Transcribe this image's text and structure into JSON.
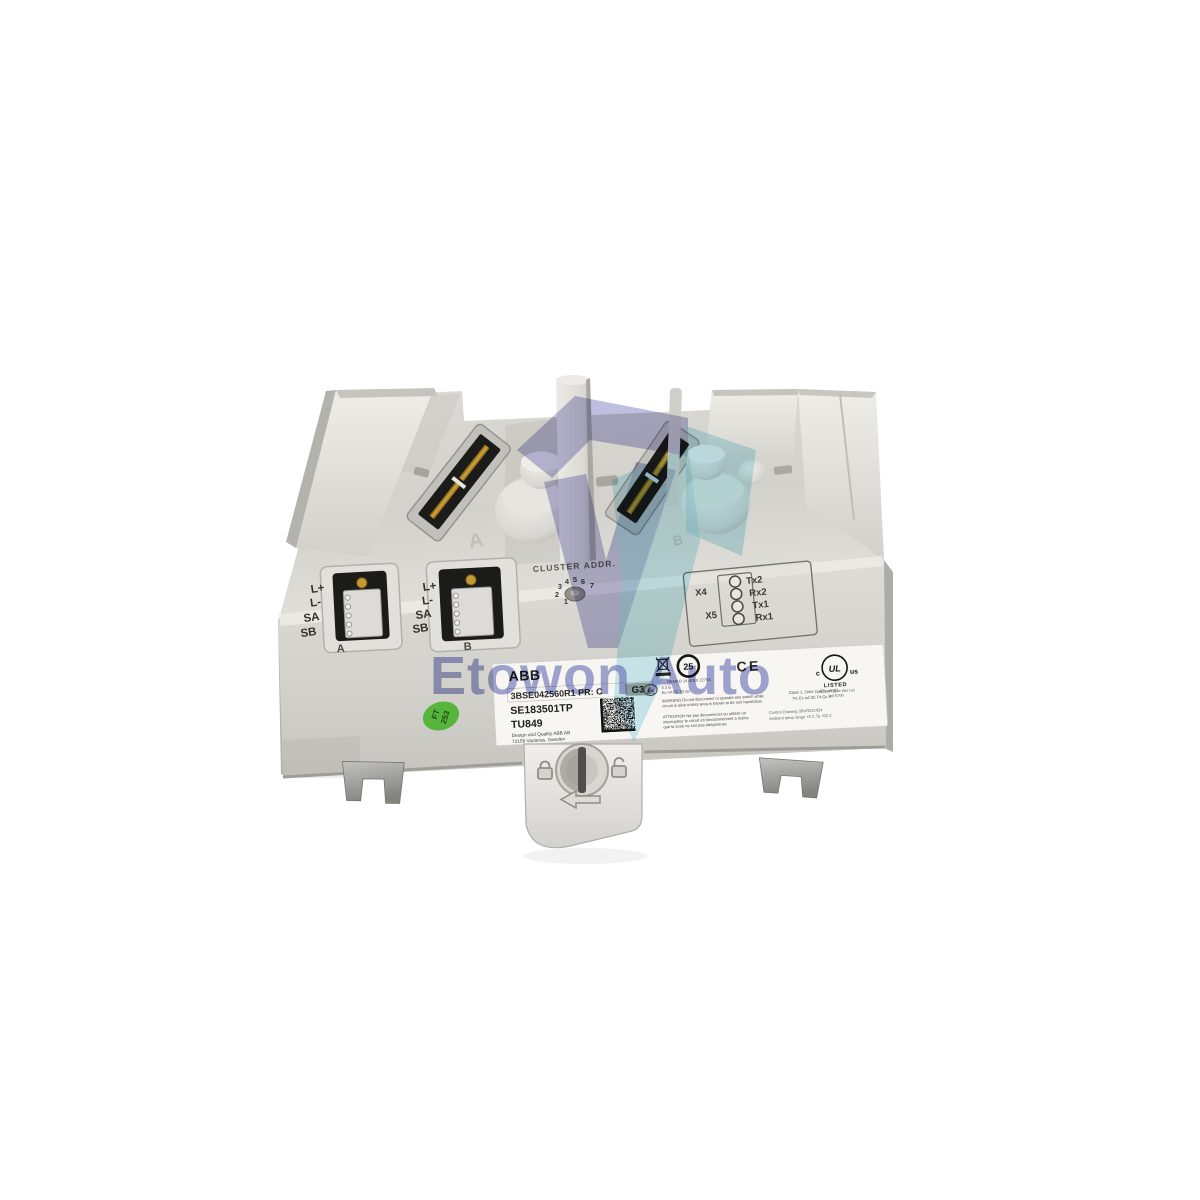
{
  "watermark": {
    "text": "Etowon Auto",
    "purple": "#7d80c0",
    "teal": "#8fd4e4",
    "text_color": "#5f68b8"
  },
  "deck": {
    "embossed_a": "A",
    "embossed_b": "B"
  },
  "cluster": {
    "label": "CLUSTER ADDR.",
    "digits": [
      "1",
      "2",
      "3",
      "4",
      "5",
      "6",
      "7"
    ]
  },
  "led_panel": {
    "x4": "X4",
    "x5": "X5",
    "leds": [
      "Tx2",
      "Rx2",
      "Tx1",
      "Rx1"
    ]
  },
  "terminals": {
    "pins": [
      "L+",
      "L-",
      "SA",
      "SB"
    ],
    "a": "A",
    "b": "B"
  },
  "label": {
    "brand": "ABB",
    "part_row": "3BSE042560R1  PR: C",
    "g3": "G3",
    "serial": "SE183501TP",
    "model": "TU849",
    "maker_line1": "Design and Quality ABB AB",
    "maker_line2": "72159 Vasteras, Sweden",
    "rohs": "25",
    "ex": "Ex",
    "ce": "CE",
    "atex": [
      "DEMKO 14 ATEX 2275X",
      "II 3 G",
      "Ex nA IIC T4 Gc"
    ],
    "warning": [
      "WARNING  Do not disconnect or operate any switch while",
      "circuit is alive unless area is known to be non hazardous"
    ],
    "attention": [
      "ATTENTION  Ne pas deconnecter ou utiliser un",
      "interrupteur le circuit en fonctionnement a moins",
      "que la zone ne soit pas dangereuse"
    ],
    "hazloc": [
      "Class 1, Zone 2, AEx nA IIC",
      "T4,  Ex nA IIC T4 Gc X"
    ],
    "control": [
      "Control Drawing 3BUR021954",
      "Ambient temp range +5 C  Ta  +55 C"
    ],
    "ul": {
      "c": "c",
      "mark": "UL",
      "us": "us",
      "listed": "LISTED",
      "sub1": "Ind Cont Eq for Haz Loc",
      "sub2": "List E200"
    }
  },
  "sticker": {
    "line1": "FT",
    "line2": "253",
    "color": "#57b53d"
  },
  "colors": {
    "body": "#d6d4ce",
    "body_light": "#e9e7e1",
    "body_shadow": "#b2b0aa",
    "recess_black": "#1b1b19",
    "gold_contact": "#c59a33",
    "label_bg": "#f7f6f2",
    "metal_tab": "#a9a9a7"
  }
}
